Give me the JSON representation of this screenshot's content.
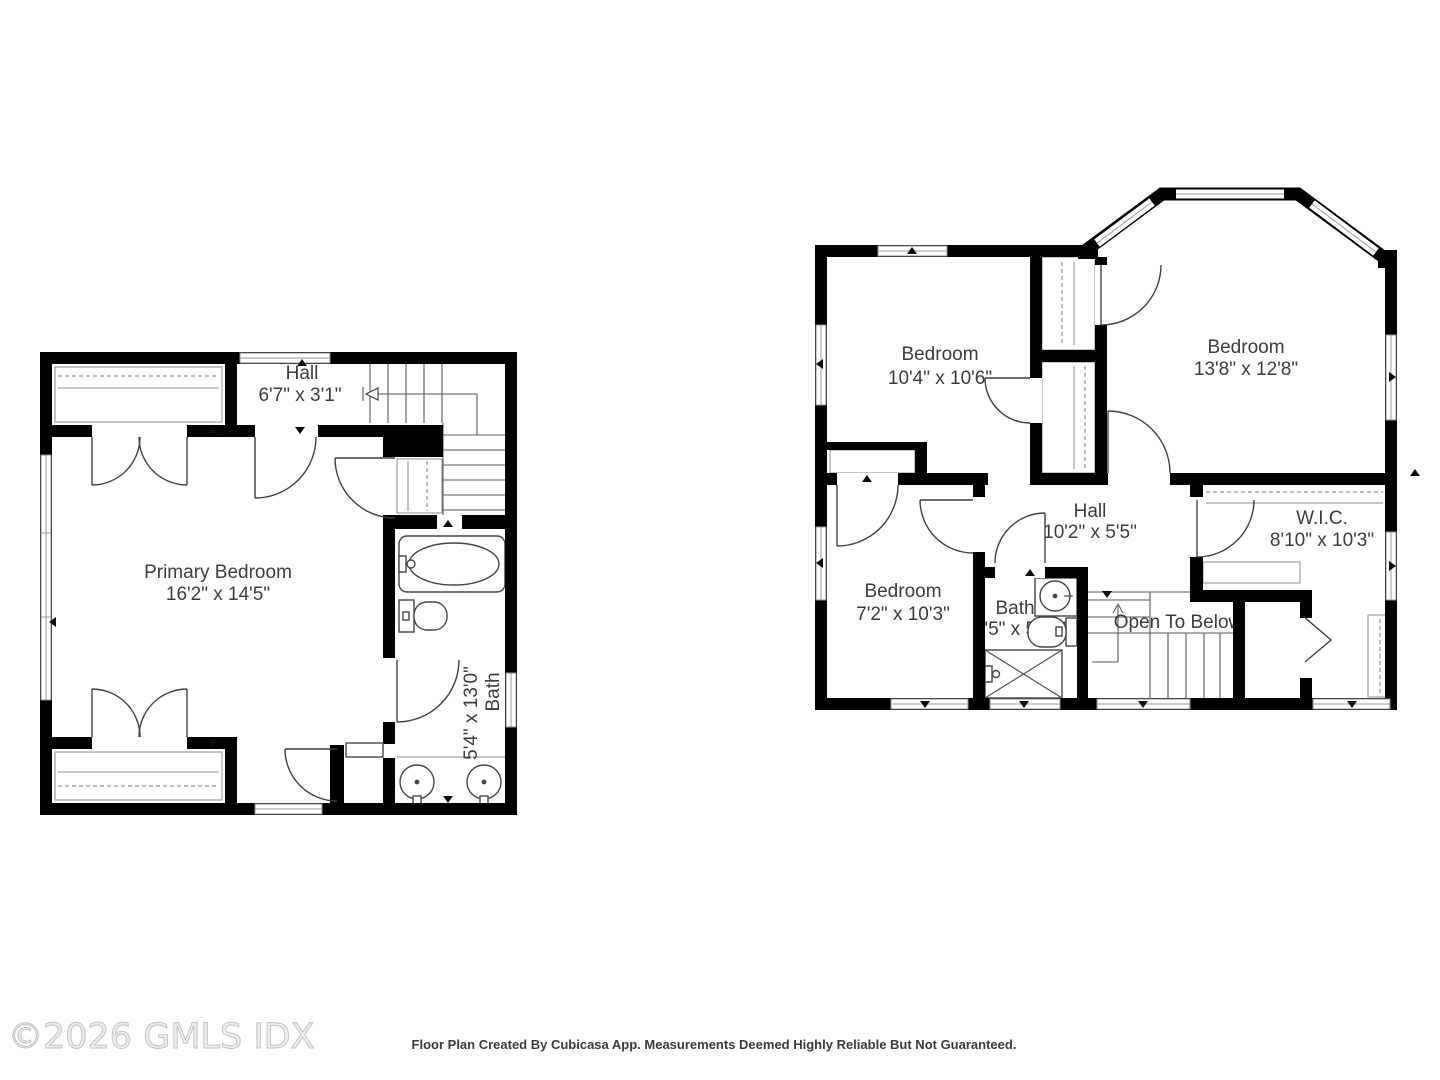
{
  "colors": {
    "wall": "#000000",
    "background": "#ffffff",
    "line": "#4f4f4f",
    "label_text": "#3a3d40",
    "watermark_text": "#ededed"
  },
  "footer": {
    "watermark": "©2026 GMLS IDX",
    "disclaimer": "Floor Plan Created By Cubicasa App. Measurements Deemed Highly Reliable But Not Guaranteed."
  },
  "left_plan": {
    "hall": {
      "name": "Hall",
      "dims": "6'7\" x 3'1\""
    },
    "primary_bedroom": {
      "name": "Primary Bedroom",
      "dims": "16'2\" x 14'5\""
    },
    "bath": {
      "name": "Bath",
      "dims": "5'4\" x 13'0\""
    }
  },
  "right_plan": {
    "bedroom_small": {
      "name": "Bedroom",
      "dims": "10'4\" x 10'6\""
    },
    "bedroom_large": {
      "name": "Bedroom",
      "dims": "13'8\" x 12'8\""
    },
    "hall": {
      "name": "Hall",
      "dims": "10'2\" x 5'5\""
    },
    "bedroom_third": {
      "name": "Bedroom",
      "dims": "7'2\" x 10'3\""
    },
    "bath": {
      "name": "Bath",
      "dims": "4'5\" x 5'11\""
    },
    "wic": {
      "name": "W.I.C.",
      "dims": "8'10\" x 10'3\""
    },
    "open_to_below": {
      "label": "Open To Below"
    }
  }
}
